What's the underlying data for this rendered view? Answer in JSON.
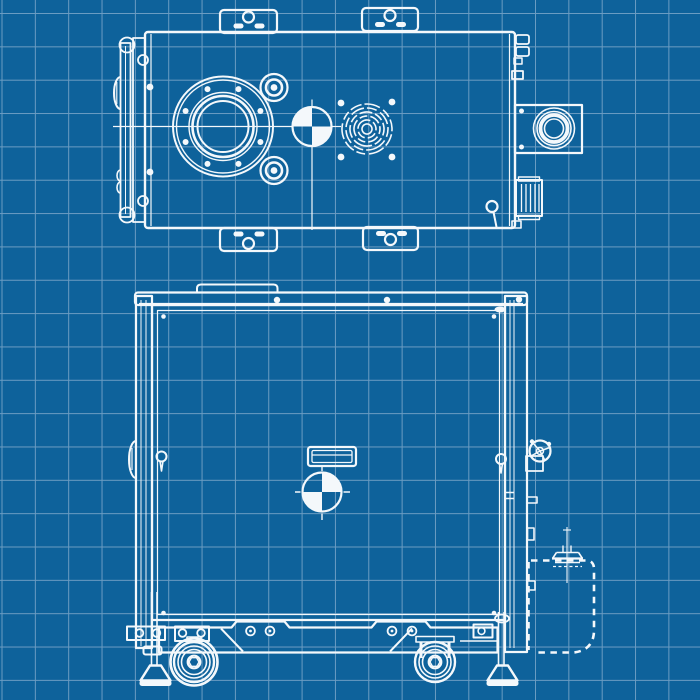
{
  "meta": {
    "description": "Blueprint-style engineering drawing of a wheeled industrial pump cabinet, shown in two orthographic views with center-of-mass symbols",
    "canvas": {
      "width": 700,
      "height": 700
    }
  },
  "colors": {
    "background": "#0e629b",
    "grid_line": "#6b9cc2",
    "line": "#f4f8fb"
  },
  "grid": {
    "cell_px": 33.35,
    "offset_x": 1.5,
    "offset_y": 13
  },
  "views": {
    "top_view": {
      "name": "top-view",
      "components": [
        "mounting-tab x4 (rounded tab, bolt circle, two slots)",
        "main-housing rectangle",
        "left-end-plate with hinge knuckles, ribbed boss, latch rings",
        "large bolted flange port (8 bolt holes)",
        "two small clamp ports",
        "center-of-mass symbol (quadrants top-left and bottom-right filled)",
        "fan scroll opening with 4 screw holes",
        "side connector box with circular port",
        "ribbed terminal block",
        "eye-bolt",
        "centerlines"
      ]
    },
    "side_view": {
      "name": "side-view",
      "components": [
        "top lifting rail with handle and bolts",
        "left and right frame rails",
        "large front panel with corner screws",
        "nameplate slot",
        "center-of-mass symbol (quadrants top-right and bottom-left filled)",
        "quarter-turn fasteners",
        "hand-wheel valve on right rail",
        "hose flange with hidden (dashed) pipe outline",
        "base frame with bolt pairs and diagonal braces",
        "two casters",
        "two leveling feet"
      ]
    }
  },
  "symbols": {
    "center_of_mass_top": {
      "cx": 312,
      "cy": 126.5,
      "r": 19.5,
      "filled_quadrants": [
        "top-left",
        "bottom-right"
      ]
    },
    "center_of_mass_side": {
      "cx": 322,
      "cy": 492,
      "r": 19.5,
      "filled_quadrants": [
        "top-right",
        "bottom-left"
      ]
    }
  }
}
